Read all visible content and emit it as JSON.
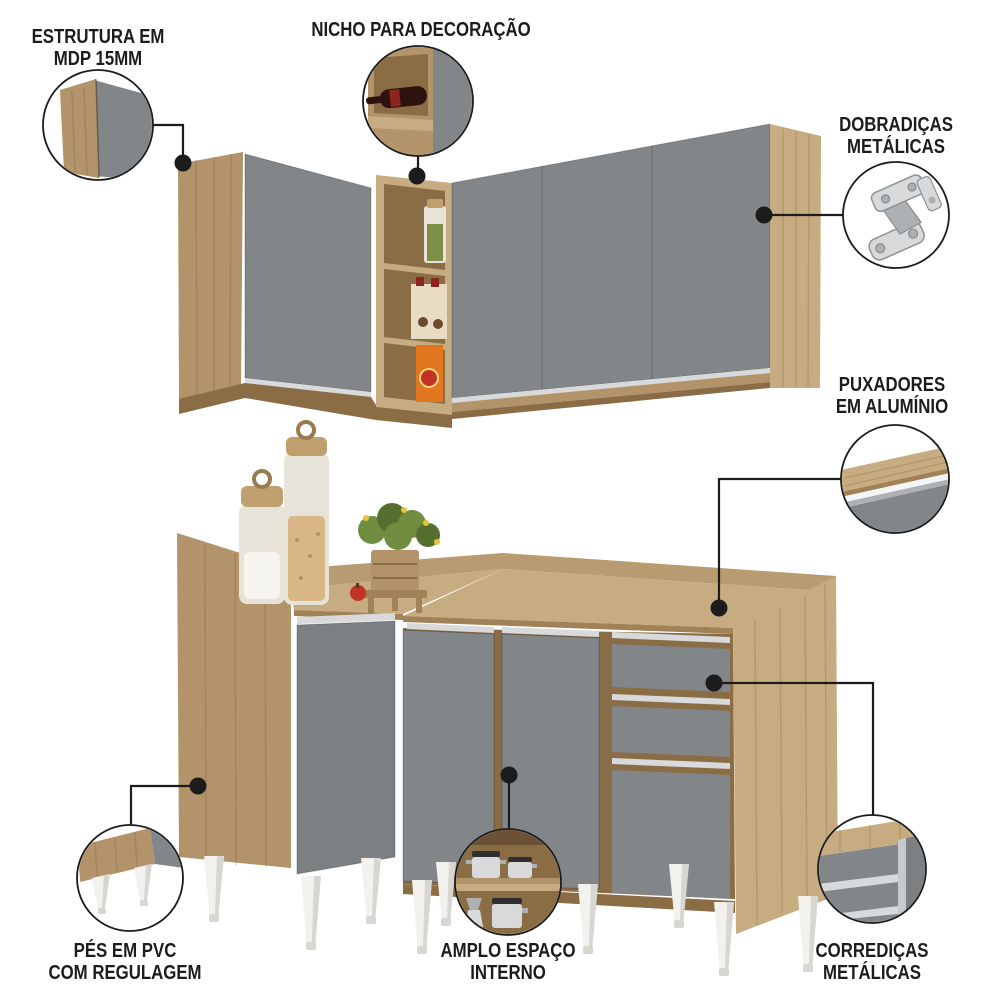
{
  "colors": {
    "background": "#ffffff",
    "line": "#1c1c1c",
    "wood_light": "#c8ac81",
    "wood_mid": "#b2936a",
    "wood_mid2": "#b89b70",
    "wood_dark": "#a08256",
    "wood_deep": "#8a6c45",
    "gray_door": "#838689",
    "gray_door_dark": "#7d8083",
    "silver": "#d7d9db",
    "silver_dark": "#aeb1b4",
    "white_feet": "#f2f1ed",
    "feet_shade": "#d7d6d1",
    "glass": "#e7e3d8",
    "flour": "#f7f5f0",
    "oats": "#d8b685",
    "lid_wood": "#c09f6e",
    "green": "#6f8c3f",
    "green_dark": "#55702e",
    "yellow": "#e5c43c",
    "apple": "#c23326",
    "orange": "#e2771f",
    "beige_box": "#e8ddc4",
    "wine": "#2e120d",
    "wine_label": "#8c2420",
    "spice": "#7c9048"
  },
  "callouts": [
    {
      "id": "estrutura",
      "icon": "panel-edge-icon",
      "lines": [
        "ESTRUTURA EM",
        "MDP 15MM"
      ]
    },
    {
      "id": "nicho",
      "icon": "wine-niche-icon",
      "lines": [
        "NICHO PARA DECORAÇÃO"
      ]
    },
    {
      "id": "dobradicas",
      "icon": "metal-hinge-icon",
      "lines": [
        "DOBRADIÇAS",
        "METÁLICAS"
      ]
    },
    {
      "id": "puxadores",
      "icon": "aluminum-handle-icon",
      "lines": [
        "PUXADORES",
        "EM ALUMÍNIO"
      ]
    },
    {
      "id": "pes",
      "icon": "pvc-feet-icon",
      "lines": [
        "PÉS EM PVC",
        "COM REGULAGEM"
      ]
    },
    {
      "id": "amplo",
      "icon": "interior-space-icon",
      "lines": [
        "AMPLO ESPAÇO",
        "INTERNO"
      ]
    },
    {
      "id": "corredicas",
      "icon": "drawer-slides-icon",
      "lines": [
        "CORREDIÇAS",
        "METÁLICAS"
      ]
    }
  ]
}
